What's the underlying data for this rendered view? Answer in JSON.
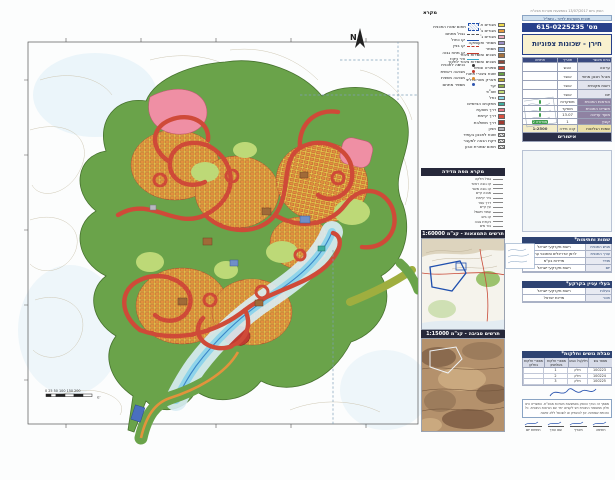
{
  "doc": {
    "meta_line": "הופק ביום 13/07/2017 באמצעות מערכת מבא\"ת",
    "strip": "תכנית מועדפת לדיור - ותמ\"ל"
  },
  "titleblock": {
    "number": "מס' 615-0225235",
    "name": "חירן - שכונות צפוניות",
    "table_header": [
      "גורם מאשר",
      "תאריך",
      "חתימה"
    ],
    "rows": [
      {
        "label": "ערוכה",
        "value": "הוגש"
      },
      {
        "label": "מנהל תכנון מחוזי",
        "value": "אושר"
      },
      {
        "label": "רשות מקומית",
        "value": "אושר"
      },
      {
        "label": "יזם",
        "value": "אושר"
      }
    ],
    "purple_rows": [
      {
        "label": "הוראות התכנית",
        "value": "מופקדות"
      },
      {
        "label": "תשריט התכנית",
        "value": "מופקד"
      },
      {
        "label": "מועד עריכה",
        "value": "13.07"
      },
      {
        "label": "קובץ",
        "value": "1",
        "badge": "מהדורה 2"
      }
    ],
    "yellow_row": {
      "label": "שמות הגליונות",
      "mid": "קנה מידה",
      "value": "1:2500"
    },
    "approvals": "אישורים"
  },
  "legend": {
    "header": "מקרא",
    "uses": [
      {
        "label": "מגורים א'",
        "color": "#f0dc4e"
      },
      {
        "label": "מגורים ב'",
        "color": "#e69a3d"
      },
      {
        "label": "מגורים ג'",
        "color": "#e9a8bc"
      },
      {
        "label": "מסחר ותעסוקה",
        "color": "#9d8fc7"
      },
      {
        "label": "מסחר",
        "color": "#7b9ed6"
      },
      {
        "label": "מבנים ומוסדות ציבור",
        "color": "#a5713f"
      },
      {
        "label": "מבנים ומוסדות ציבור לחינוך",
        "color": "#8c4a3c"
      },
      {
        "label": "ספורט ונופש",
        "color": "#cc4533"
      },
      {
        "label": "שטח ציבורי פתוח",
        "color": "#67a046"
      },
      {
        "label": "פארק מטרופוליני",
        "color": "#b7a636"
      },
      {
        "label": "יער",
        "color": "#8fae4a"
      },
      {
        "label": "שצ\"פ",
        "color": "#c3dc78"
      },
      {
        "label": "נחל",
        "color": "#8fd8e8"
      },
      {
        "label": "מתקנים הנדסיים",
        "color": "#3fae9e"
      },
      {
        "label": "דרך מוצעת",
        "color": "#e87a86"
      },
      {
        "label": "דרך קיימת",
        "color": "#d94f3f"
      },
      {
        "label": "דרך משולבת",
        "color": "#a03a30"
      },
      {
        "label": "חניון",
        "color": "#b8b8c0"
      },
      {
        "label": "שטח לתכנון בעתיד",
        "color": "hatch"
      },
      {
        "label": "זיקת הנאה למעבר",
        "color": "hatch"
      },
      {
        "label": "תחום שמורת טבע",
        "color": "hatch"
      }
    ],
    "symbols_box_label": "תחום שטח התכנית",
    "symbols": [
      {
        "label": "גבול מתחם",
        "type": "dash-gray"
      },
      {
        "label": "קו כחול",
        "type": "line-blue"
      },
      {
        "label": "קו בניין",
        "type": "dash-red"
      },
      {
        "label": "קו מתח גבוה",
        "type": "line-red"
      },
      {
        "label": "ציר ניקוז",
        "type": "line-cyan"
      },
      {
        "label": "כניסה לתכנית",
        "type": "dot-black"
      },
      {
        "label": "מבואה ראשית",
        "type": "dot-red"
      },
      {
        "label": "מבואה משנית",
        "type": "dot-orange"
      },
      {
        "label": "מספר מתחם",
        "type": "dot-blue"
      }
    ],
    "survey": {
      "header": "מקרא מפת מדידה",
      "items": [
        "גבול חלקה",
        "קו גובה ראשי",
        "קו גובה משני",
        "מבנה קיים",
        "גדר קיימת",
        "דרך עפר",
        "עץ קיים",
        "עמוד חשמל",
        "קו ביוב",
        "נקודת גובה",
        "בור מים",
        "שביל"
      ]
    }
  },
  "diagrams": {
    "orientation_header": "תרשים התמצאות - קנ\"מ 1:60000",
    "environment_header": "תרשים סביבה - קנ\"מ 1:15000"
  },
  "signatures": {
    "header": "שמות וחתימות*",
    "rows": [
      {
        "label": "מגיש התכנית",
        "value": "רשות מקרקעי ישראל"
      },
      {
        "label": "עורך התכנית",
        "value": "לרמן אדריכלים ומתכנני ערים"
      },
      {
        "label": "מודד",
        "value": "מדידות בע\"מ"
      },
      {
        "label": "יזם",
        "value": "רשות מקרקעי ישראל"
      }
    ]
  },
  "stakeholders": {
    "header": "בעלי עניין בקרקע*",
    "rows": [
      {
        "label": "בעלות",
        "value": "רשות מקרקעי ישראל"
      },
      {
        "label": "חוכר",
        "value": "מדינת ישראל"
      }
    ]
  },
  "parcels": {
    "header": "טבלת גושים וחלקות*",
    "columns": [
      "מספר גוש",
      "חלק/כל הגוש",
      "מספרי חלקות בשלמותן",
      "מספרי חלקות בחלקן"
    ],
    "rows": [
      [
        "100223",
        "חלק",
        "1",
        ""
      ],
      [
        "100224",
        "חלק",
        "2",
        ""
      ],
      [
        "100225",
        "חלק",
        "3",
        ""
      ]
    ]
  },
  "footer": {
    "paragraph": "מסמך זה נערך והופק באמצעות מערכת מבא\"ת. התשריט הינו חלק ממסמכי התכנית ויש לקוראו יחד עם הוראות התכנית. כל הזכויות שמורות. אין להעתיק או לשכפל ללא אישור.",
    "sig_labels": [
      "חתימה",
      "תאריך",
      "שם עורך",
      "חתימת יזם"
    ]
  },
  "map": {
    "north": "N",
    "scale_labels": "0  25 50    100     150     200",
    "scale_unit": "מ'"
  }
}
